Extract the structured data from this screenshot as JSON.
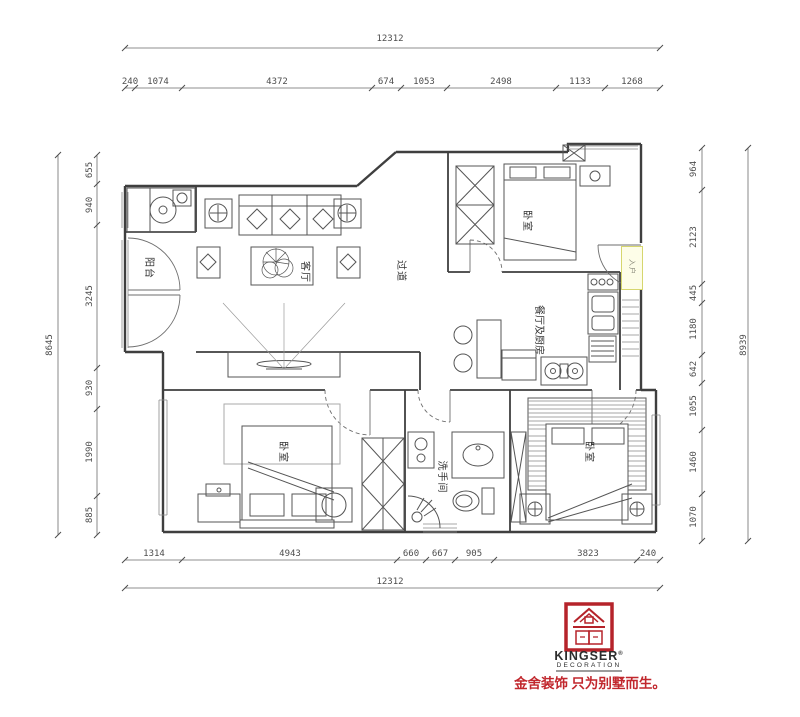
{
  "dimensions": {
    "top_total": "12312",
    "top_segments": [
      "240",
      "1074",
      "4372",
      "674",
      "1053",
      "2498",
      "1133",
      "1268"
    ],
    "bottom_segments": [
      "1314",
      "4943",
      "660",
      "667",
      "905",
      "3823",
      "240"
    ],
    "bottom_total": "12312",
    "left_total": "8645",
    "left_segments": [
      "655",
      "940",
      "3245",
      "930",
      "1990",
      "885"
    ],
    "right_segments": [
      "964",
      "2123",
      "445",
      "1180",
      "642",
      "1055",
      "1460",
      "1070"
    ],
    "right_total": "8939"
  },
  "rooms": {
    "balcony": "阳台",
    "living_room": "客厅",
    "hallway": "过道",
    "bedroom_top": "卧室",
    "dining_kitchen": "餐厅及厨房",
    "entry": "入户",
    "bedroom_left": "卧室",
    "bathroom": "洗手间",
    "bedroom_right": "卧室"
  },
  "logo": {
    "brand": "KINGSER",
    "registered": "®",
    "subtitle": "DECORATION",
    "slogan": "金舍装饰 只为别墅而生。"
  },
  "colors": {
    "wall_line": "#3f3f3f",
    "highlight_fill": "#fdfde8",
    "highlight_border": "#d6d66e",
    "logo_red": "#b5232a",
    "slogan_red": "#c1272d"
  }
}
